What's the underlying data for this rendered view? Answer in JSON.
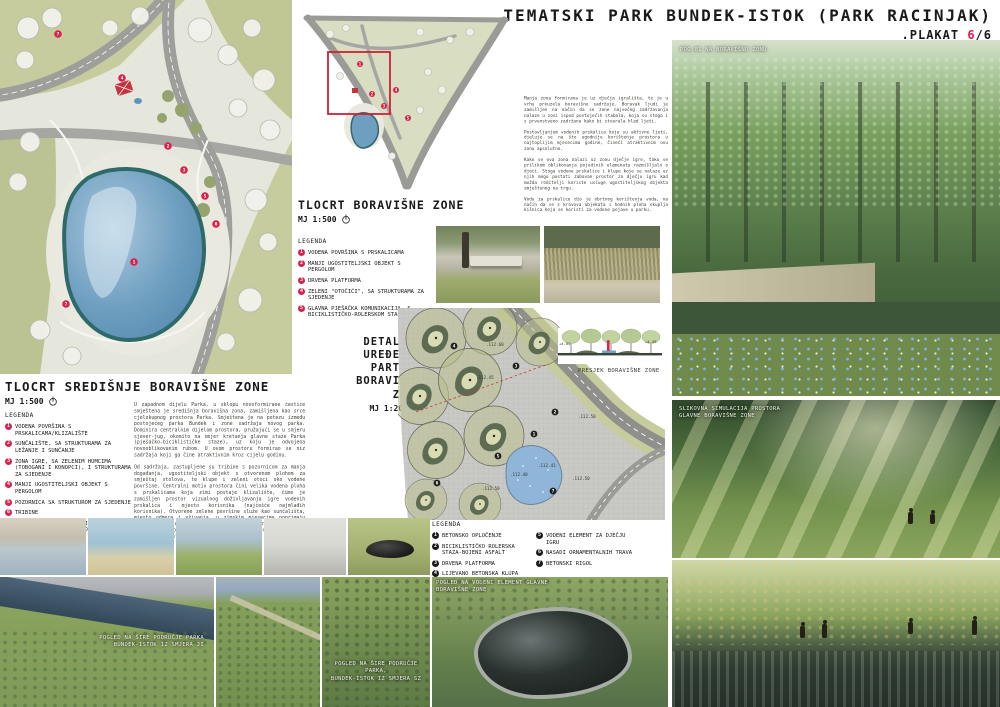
{
  "header": {
    "title": "TEMATSKI PARK BUNDEK-ISTOK (PARK RACINJAK)",
    "plakat_label": ".PLAKAT ",
    "plakat_num": "6",
    "plakat_total": "/6"
  },
  "plan_central": {
    "title": "TLOCRT SREDIŠNJE BORAVIŠNE ZONE",
    "scale": "MJ 1:500",
    "legend_heading": "LEGENDA",
    "legend": [
      {
        "n": "1",
        "label": "VODENA POVRŠINA S PRSKALICAMA/KLIZALIŠTE"
      },
      {
        "n": "2",
        "label": "SUNČALIŠTE, SA STRUKTURAMA ZA LEŽANJE I SUNČANJE"
      },
      {
        "n": "3",
        "label": "ZONA IGRE, SA ZELENIM HUMCIMA (TOBOGANI I KONOPCI), I STRUKTURAMA ZA SJEDENJE"
      },
      {
        "n": "4",
        "label": "MANJI UGOSTITELJSKI OBJEKT S PERGOLOM"
      },
      {
        "n": "5",
        "label": "POZORNICA SA STRUKTUROM ZA SJEDENJE"
      },
      {
        "n": "6",
        "label": "TRIBINE"
      },
      {
        "n": "7",
        "label": "GLAVNA PJEŠAČKA KOMUNIKACIJA, S BICIKLISTIČKO-ROLERSKOM STAZOM"
      }
    ],
    "markers": [
      "7",
      "4",
      "2",
      "3",
      "5",
      "6",
      "1",
      "7"
    ]
  },
  "plan_mini": {
    "title": "TLOCRT BORAVIŠNE ZONE",
    "scale": "MJ 1:500",
    "legend_heading": "LEGENDA",
    "legend": [
      {
        "n": "1",
        "label": "VODENA POVRŠINA S PRSKALICAMA"
      },
      {
        "n": "2",
        "label": "MANJI UGOSTITELJSKI OBJEKT S PERGOLOM"
      },
      {
        "n": "3",
        "label": "DRVENA PLATFORMA"
      },
      {
        "n": "4",
        "label": "ZELENI \"OTOČIĆI\", SA STRUKTURAMA ZA SJEDENJE"
      },
      {
        "n": "5",
        "label": "GLAVNA PJEŠAČKA KOMUNIKACIJA, S BICIKLISTIČKO-ROLERSKOM STAZOM"
      }
    ],
    "markers": [
      "1",
      "2",
      "3",
      "4",
      "5"
    ]
  },
  "plan_detail": {
    "title_l1": "DETALJNO UREĐENJE",
    "title_l2": "PARTERA BORAVIŠNE",
    "title_l3": "ZONE",
    "scale": "MJ 1:200",
    "legend_heading": "LEGENDA",
    "legend_left": [
      {
        "n": "1",
        "label": "BETONSKO OPLOČENJE"
      },
      {
        "n": "2",
        "label": "BICIKLISTIČKO ROLERSKA STAZA-BOJENI ASFALT"
      },
      {
        "n": "3",
        "label": "DRVENA PLATFORMA"
      },
      {
        "n": "4",
        "label": "LIJEVANO BETONSKA KLUPA"
      }
    ],
    "legend_right": [
      {
        "n": "5",
        "label": "VODENI ELEMENT ZA DJEČJU IGRU"
      },
      {
        "n": "6",
        "label": "NASADI ORNAMENTALNIH TRAVA"
      },
      {
        "n": "7",
        "label": "BETONSKI RIGOL"
      }
    ],
    "markers": [
      "1",
      "2",
      "3",
      "4",
      "5",
      "6",
      "7"
    ],
    "elevations": [
      ".112.60",
      ".112.45",
      ".112.50",
      ".112.41",
      ".112.40",
      ".112.50",
      ".112.50"
    ]
  },
  "section": {
    "caption": "PRESJEK BORAVIŠNE ZONE",
    "elev_left": "+4.05",
    "elev_right": "+4.49"
  },
  "texts": {
    "left_p1": "U zapadnom dijelu Parka, u sklopu novoformirane čestice smještena je središnja boravišna zona, zamišljena kao srce cjelokupnog prostora Parka. Smještena je na potezu između postojećeg parka Bundek i zone sadržaja novog parka. Dominira centralnim dijelom prostora, pružajući se u smjeru sjever-jug, okomito na smjer kretanja glavne staze Parka (pješačko-biciklističke staze), uz koju je odvojena novooblikovanim rubom. U ovom prostoru formirao se niz sadržaja koji ga čine atraktivnim kroz cijelu godinu.",
    "left_p2": "Od sadržaja, zastupljene su tribine s pozornicom za manja događanja, ugostiteljski objekt s otvorenom plohom za smještaj stolova, te klupe i zeleni otoci oko vodene površine. Centralni motiv prostora čini velika vodena ploha s prskalicama koja zimi postaje klizalište, čime je zamišljen prostor vizualnog doživljavanja igre vodenih prskalica i mjesto korisnika (najčešće najmlađih korisnika). Otvorene zelene površine služe kao sunčališta, mjesto odmora i uživanja, u zimskim mjesecima poprimaju funkciju klizališta te se korisnicima pruža mogućnost doživljaja ugodnih prostora i u deprimirajućim uvjetima, pritom koristeći prirodne krajobrazne i visinske vegetacije.",
    "right_p1": "Manja zona formirana je uz dječja igrališta, te je u vrhu preuzela boravišne sadržaje. Boravak ljudi je zamišljen na način da se zone najvećeg zadržavanja nalaze u zoni ispod postojećih stabala, koja su stoga i s prvenstveno zadržana kako bi stvarala hlad ljeti.",
    "right_p2": "Postavljanjem vodenih prskalica koje su aktivne ljeti, djeluje se na što ugodnije korištenje prostora u najtoplijim mjesecima godine, čineći atraktivnim ovu zonu apsolutno.",
    "right_p3": "Kako se ova zona nalazi uz zonu dječje igre, tako se prilikom oblikovanja pojedinih elemenata razmišljalo o djeci. Stoga vodene prskalice i klupe koje se nalaze uz njih mogu postati zabavan prostor za dječju igru kad možda roditelji koriste usluge ugostiteljskog objekta smještenog na trgu.",
    "right_p4": "Vodu za prskalice dio je obrtnog korištenja voda, na način da se s krovova objekata i hodnih ploha skuplja kišnica koja se koristi za vodene pojave u parku."
  },
  "captions": {
    "view01": "POG.01 NA BORAVIŠNU ZONU",
    "sim_l1": "SLIKOVNA SIMULACIJA PROSTORA",
    "sim_l2": "GLAVNE BORAVIŠNE ZONE",
    "aerial_ji_l1": "POGLED NA ŠIRE PODRUČJE PARKA",
    "aerial_ji_l2": "BUNDEK-ISTOK IZ SMJERA JI",
    "aerial_sz_l1": "POGLED NA ŠIRE PODRUČJE PARKA,",
    "aerial_sz_l2": "BUNDEK-ISTOK IZ SMJERA SZ",
    "water_l1": "POGLED NA VODENI ELEMENT GLAVNE",
    "water_l2": "BORAVIŠNE ZONE"
  },
  "colors": {
    "accent_red": "#e8174b",
    "marker_red": "#d6224c",
    "pond_blue": "#6f9fc0",
    "grass_green": "#c6cc9e"
  }
}
